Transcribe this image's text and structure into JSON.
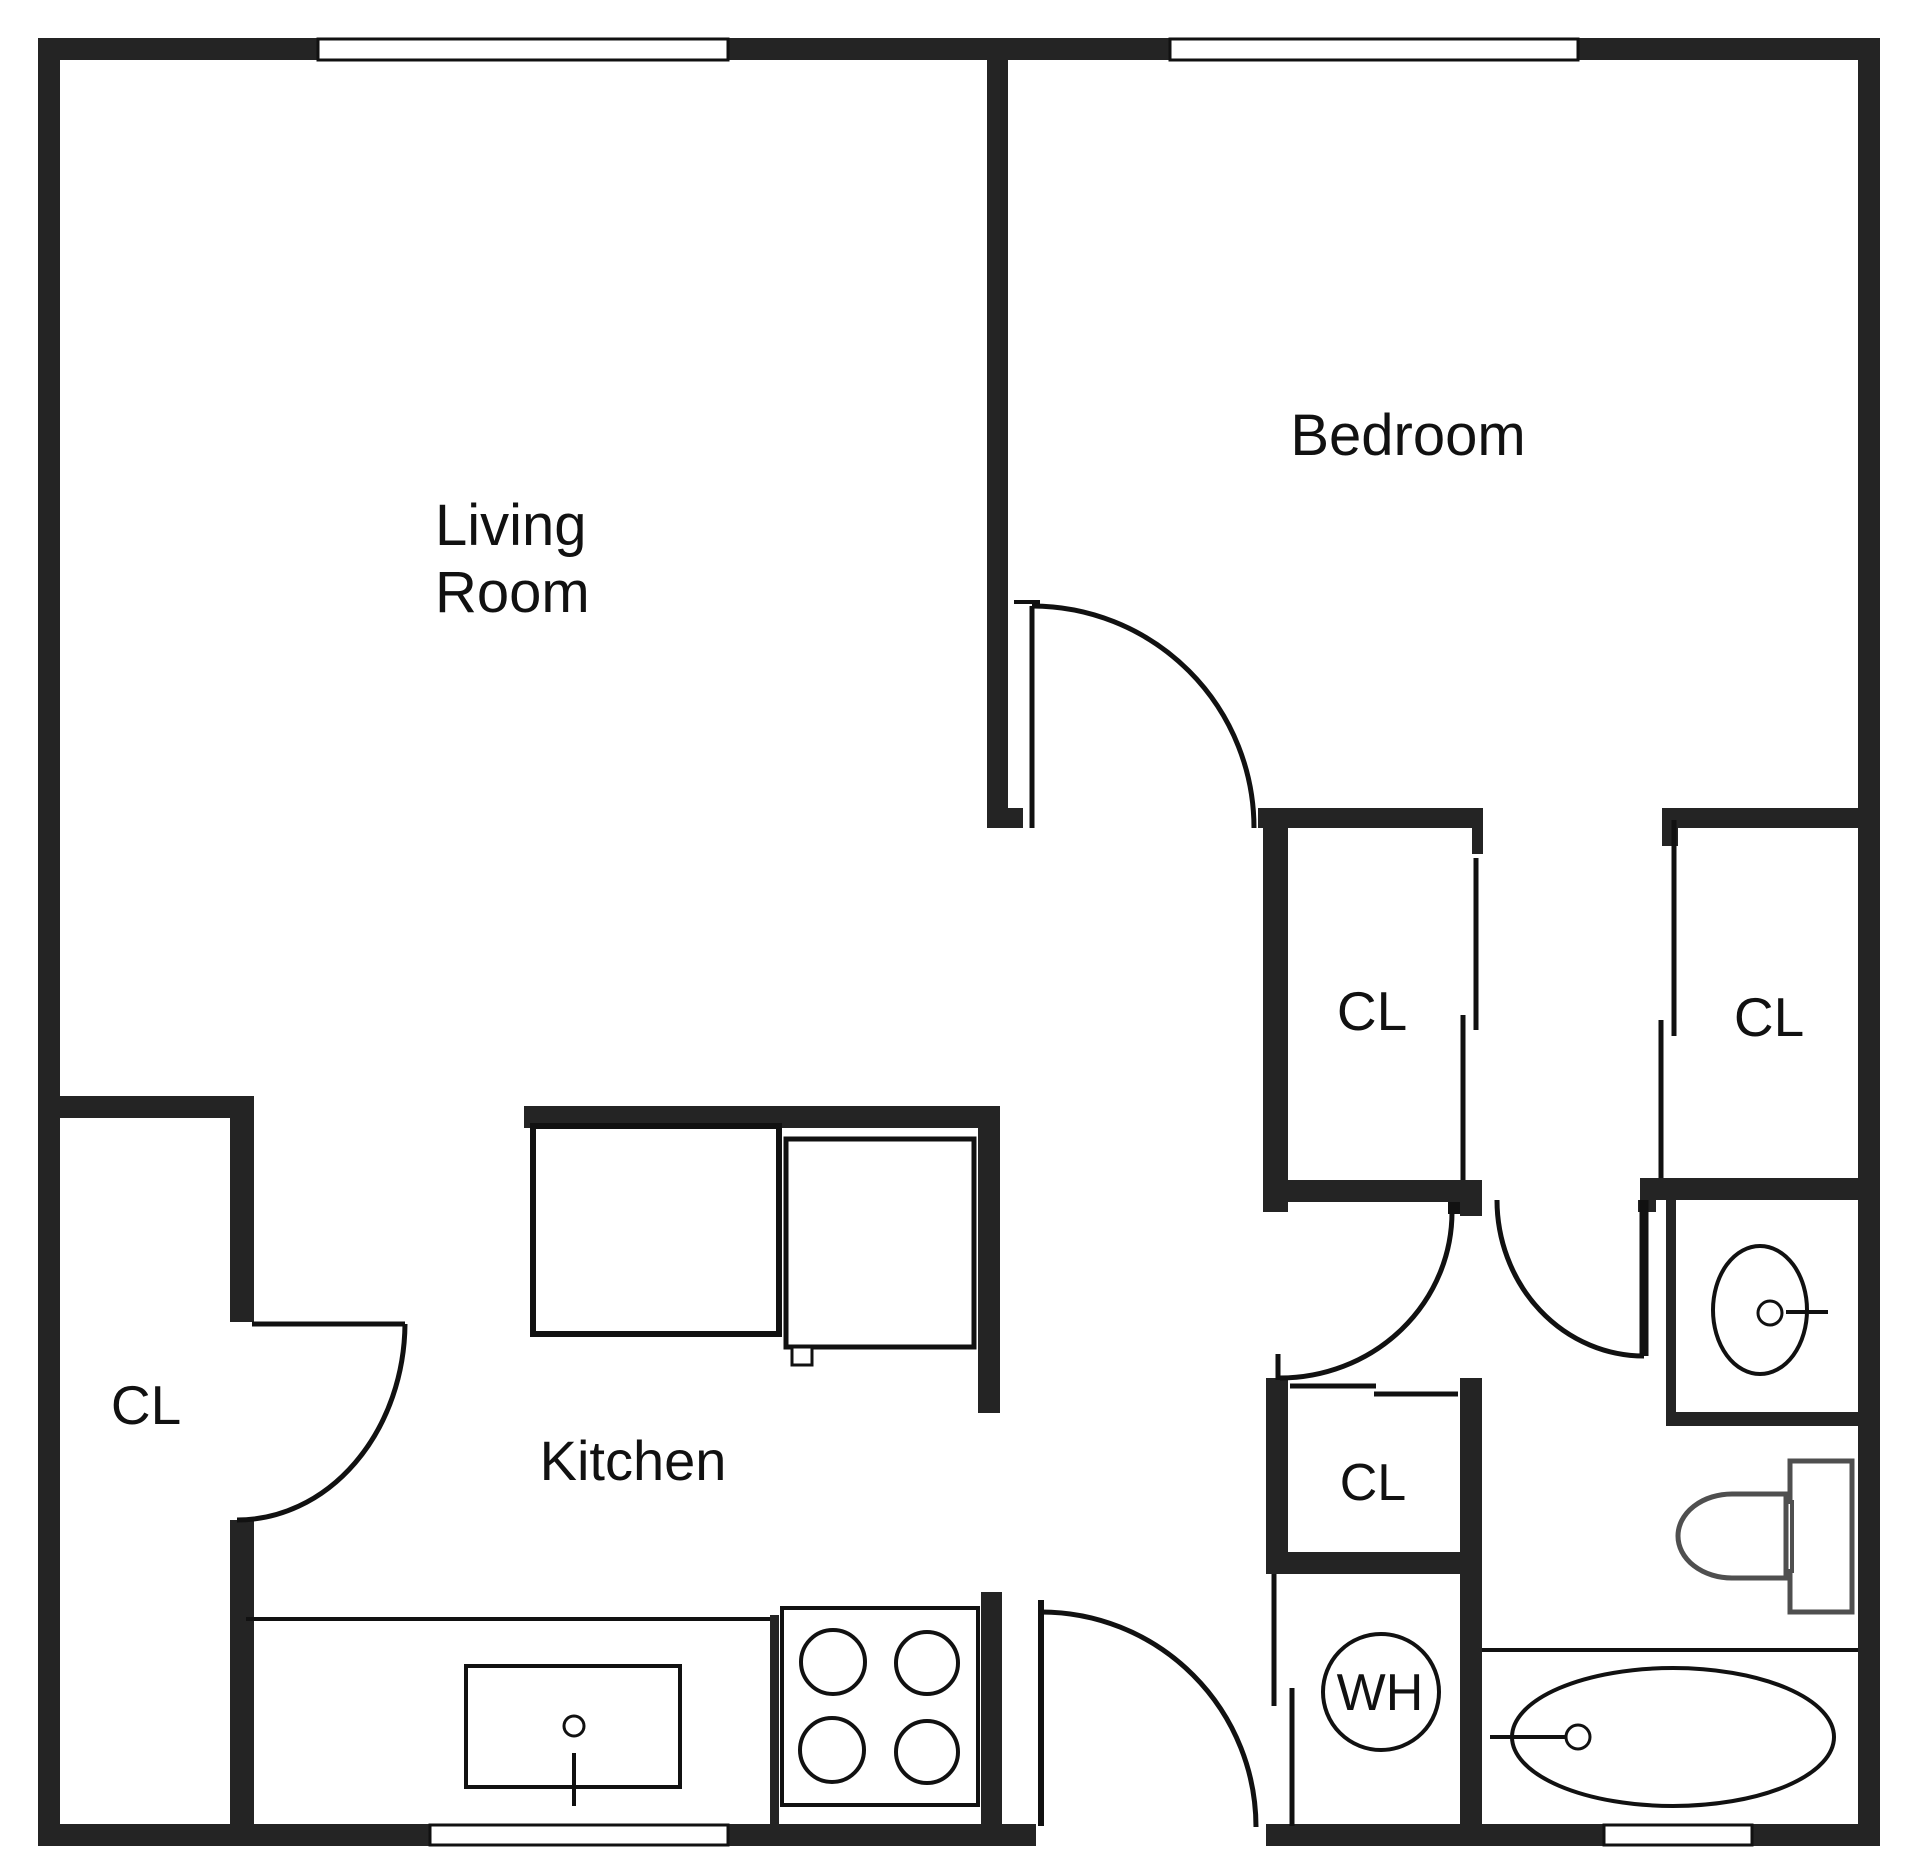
{
  "rooms": {
    "living_room": {
      "line1": "Living",
      "line2": "Room"
    },
    "bedroom": {
      "label": "Bedroom"
    },
    "kitchen": {
      "label": "Kitchen"
    }
  },
  "closets": {
    "left": {
      "label": "CL"
    },
    "hall": {
      "label": "CL"
    },
    "bedroom_side": {
      "label": "CL"
    },
    "small": {
      "label": "CL"
    }
  },
  "water_heater": {
    "label": "WH"
  },
  "colors": {
    "wall": "#242424",
    "line": "#111111",
    "toilet": "#4f4f4f",
    "window_fill": "#ffffff",
    "background": "#ffffff",
    "text": "#111111"
  },
  "fixture_names": [
    "stove-icon",
    "kitchen-sink-icon",
    "refrigerator-icon",
    "counter-icon",
    "bathroom-sink-icon",
    "toilet-icon",
    "bathtub-icon",
    "water-heater-icon",
    "door-swing-icon",
    "sliding-door-icon",
    "window-icon"
  ]
}
